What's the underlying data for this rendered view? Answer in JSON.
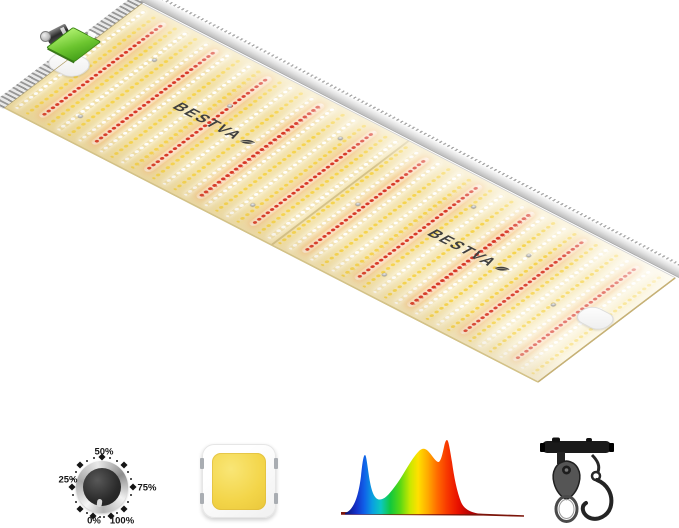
{
  "brand": {
    "name": "BESTVA"
  },
  "colors": {
    "background": "#ffffff",
    "board_base": "#f0dfa6",
    "board_base_light": "#f9f0ce",
    "cool_led": "#ffffff",
    "warm_led": "#f6d44e",
    "red_led": "#d83a28",
    "red_glow": "#fdeadc",
    "rail_silver": "#d9d9d9",
    "connector_green": "#6cc52f",
    "chip_die_yellow": "#f3d549",
    "logo_gray": "#3f3f3f",
    "hardware_black": "#1a1a1a",
    "spectrum_baseline": "#7c150a"
  },
  "panel": {
    "logos": [
      {
        "text": "BESTVA"
      },
      {
        "text": "BESTVA"
      }
    ],
    "rows": {
      "count": 50,
      "start_x": 6,
      "spacing": 11.85,
      "red_period": 5,
      "red_offset": 2
    },
    "screws": [
      [
        56,
        47
      ],
      [
        147,
        54
      ],
      [
        250,
        30
      ],
      [
        250,
        140
      ],
      [
        400,
        30
      ],
      [
        400,
        142
      ],
      [
        540,
        86
      ],
      [
        56,
        140
      ],
      [
        480,
        50
      ],
      [
        320,
        86
      ]
    ]
  },
  "features": {
    "dimmer": {
      "labels": {
        "top": "50%",
        "left": "25%",
        "right": "75%",
        "bottom_left": "0%",
        "bottom_right": "100%"
      },
      "marker_angles_deg": [
        0,
        45,
        90,
        135,
        162,
        198,
        225,
        270,
        315
      ],
      "dot_angles_deg": [
        15,
        30,
        60,
        75,
        105,
        120,
        150,
        176,
        184,
        210,
        240,
        255,
        285,
        300,
        330,
        345
      ]
    },
    "led_chip": {
      "kind": "smd-warm-white-chip"
    },
    "spectrum": {
      "kind": "full-spectrum-curve",
      "gradient": [
        {
          "o": "0%",
          "c": "#0a1070"
        },
        {
          "o": "8%",
          "c": "#1430c8"
        },
        {
          "o": "14%",
          "c": "#1060e8"
        },
        {
          "o": "20%",
          "c": "#0aa0e0"
        },
        {
          "o": "26%",
          "c": "#0cc8c0"
        },
        {
          "o": "33%",
          "c": "#12c83c"
        },
        {
          "o": "40%",
          "c": "#58d814"
        },
        {
          "o": "47%",
          "c": "#c8e800"
        },
        {
          "o": "53%",
          "c": "#ffe000"
        },
        {
          "o": "60%",
          "c": "#ffaa00"
        },
        {
          "o": "67%",
          "c": "#ff6a00"
        },
        {
          "o": "74%",
          "c": "#f83800"
        },
        {
          "o": "82%",
          "c": "#e81000"
        },
        {
          "o": "90%",
          "c": "#b80404"
        },
        {
          "o": "100%",
          "c": "#8c0202"
        }
      ]
    },
    "hanger": {
      "kind": "rope-ratchet-hanger"
    }
  }
}
